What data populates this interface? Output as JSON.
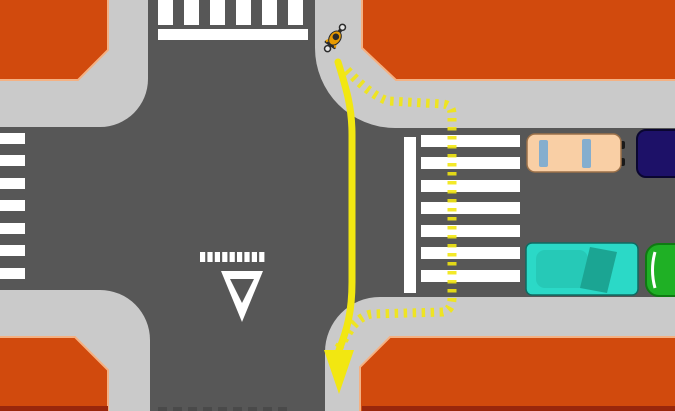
{
  "title": "intersection-cyclist-crossing-diagram",
  "colors": {
    "road": "#575757",
    "sidewalk": "#CACACA",
    "block": "#D14A0D",
    "block_border": "#F4B183",
    "block_bottom_strip": "#99270C",
    "stripe": "#FFFFFF",
    "marking_white": "#FFFFFF",
    "route_yellow": "#F2E711",
    "faint_mark": "#4A4A4A",
    "car_beige": "#F9CFA5",
    "car_beige_outline": "#9C7149",
    "car_window_blue": "#85AECE",
    "mirror_black": "#1A1A1A",
    "car_navy": "#1D1168",
    "car_navy_outline": "#0A0630",
    "car_teal": "#2BD9C7",
    "car_teal_roof": "#26C9B7",
    "car_teal_windshield": "#1BA593",
    "car_teal_outline": "#0E6B62",
    "car_green": "#1FB025",
    "car_green_outline": "#0F7A12",
    "cyclist_body": "#E79A00",
    "cyclist_dark": "#2B2B2B",
    "wheel_hub": "#E6E6E6"
  },
  "scene": {
    "cyclist": "cyclist",
    "vehicles": [
      "beige-car",
      "navy-car",
      "teal-car",
      "green-car"
    ],
    "routes": [
      "solid-direct-route",
      "dashed-crosswalk-route"
    ],
    "markings": [
      "zebra-crossing-top",
      "zebra-crossing-left",
      "zebra-crossing-right",
      "stop-line-top",
      "stop-line-right",
      "yield-dash-line",
      "yield-triangle"
    ]
  }
}
